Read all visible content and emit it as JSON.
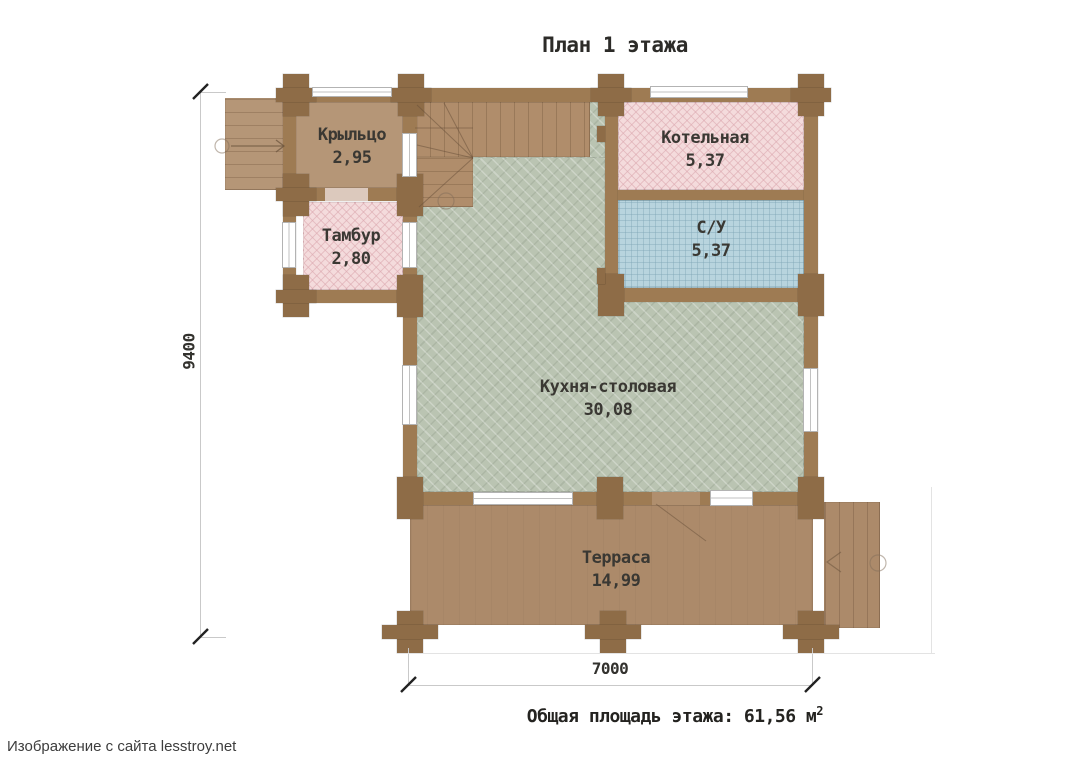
{
  "title": "План 1 этажа",
  "rooms": [
    {
      "id": "porch",
      "name": "Крыльцо",
      "area": "2,95"
    },
    {
      "id": "tambour",
      "name": "Тамбур",
      "area": "2,80"
    },
    {
      "id": "boiler",
      "name": "Котельная",
      "area": "5,37"
    },
    {
      "id": "wc",
      "name": "С/У",
      "area": "5,37"
    },
    {
      "id": "kitchen",
      "name": "Кухня-столовая",
      "area": "30,08"
    },
    {
      "id": "terrace",
      "name": "Терраса",
      "area": "14,99"
    }
  ],
  "dimensions": {
    "vertical": "9400",
    "horizontal": "7000"
  },
  "summary": {
    "label": "Общая площадь этажа:",
    "value": "61,56",
    "unit": "м",
    "superscript": "2"
  },
  "attribution": "Изображение с сайта lesstroy.net",
  "colors": {
    "wall": "#9e7b53",
    "post": "#8e6c47",
    "room_pink": "#f4dbdc",
    "room_blue": "#b8d4de",
    "room_green": "#bac4b2",
    "wood_light": "#b59677",
    "wood_terrace": "#ac8a6a"
  }
}
